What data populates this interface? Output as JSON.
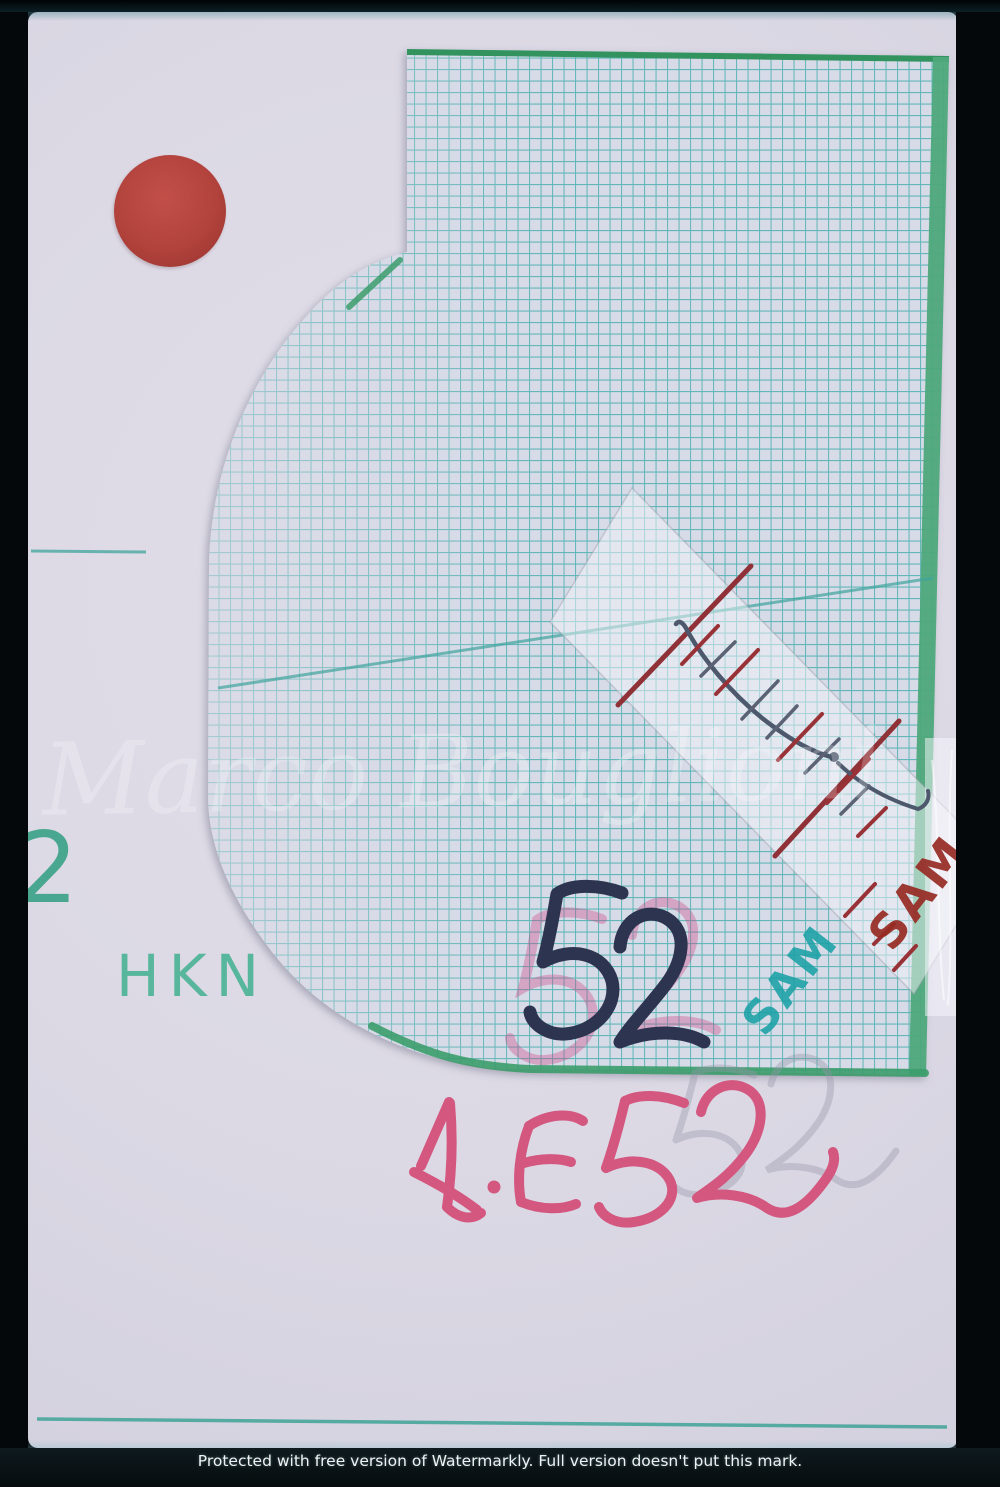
{
  "annotations": {
    "sheet_number_dark": "52",
    "sheet_number_ghost_pink": "52",
    "catalog_code": "A·E 52",
    "catalog_code_ghost": "52",
    "brand": "HKN",
    "index_digit": "2",
    "stamp_teal": "SAM",
    "stamp_red": "SAM"
  },
  "watermark": {
    "name": "Marco Bouglioni",
    "footer": "Protected with free version of Watermarkly. Full version doesn't put this mark."
  },
  "colors": {
    "grid_line": "#4fb0b2",
    "grid_paper": "#d6dbe7",
    "edge_green": "#3c9c6c",
    "teal_print": "#4faa90",
    "red_dot_sticker": "#b2423c",
    "ink_dark_navy": "#2d3450",
    "ink_pink": "#d4577f",
    "ink_dark_red": "#8f3136",
    "stamp_teal": "#1aa0a5",
    "stamp_red": "#9b2b24"
  }
}
